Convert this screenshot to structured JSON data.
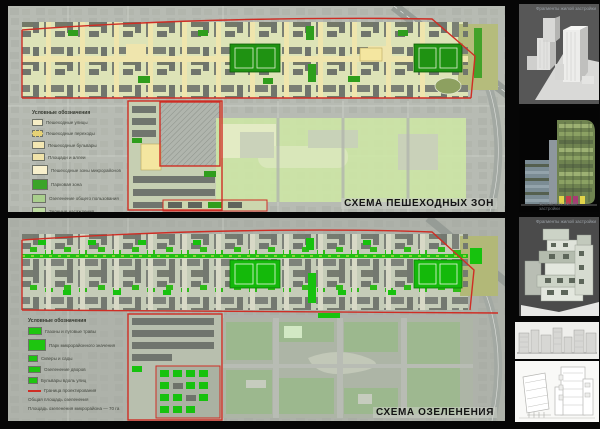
{
  "board": {
    "title": "Градостроительная концепция — схемы микрорайона"
  },
  "maps": [
    {
      "caption": "СХЕМА ПЕШЕХОДНЫХ ЗОН",
      "legend": {
        "title": "Условные обозначения",
        "items": [
          {
            "swatch": "#f6eec6",
            "label": "Пешеходные улицы"
          },
          {
            "swatch": "#e6d275",
            "label": "Пешеходные переходы"
          },
          {
            "swatch": "#f3e7b2",
            "label": "Пешеходные бульвары"
          },
          {
            "swatch": "#f0e3a9",
            "label": "Площади и аллеи"
          },
          {
            "swatch": "#f8f0cc",
            "label": "Пешеходные зоны микрорайонов"
          },
          {
            "swatch": "#3aa428",
            "label": "Парковая зона"
          },
          {
            "swatch": "#a9cf8c",
            "label": "Озеленение общего пользования"
          },
          {
            "swatch": "#bedca2",
            "label": "Зеленые насаждения"
          }
        ]
      }
    },
    {
      "caption": "СХЕМА ОЗЕЛЕНЕНИЯ",
      "legend": {
        "title": "Условные обозначения",
        "items": [
          {
            "swatch": "#1ec510",
            "label": "Газоны и луговые травы"
          },
          {
            "swatch": "#1ec510",
            "label": "Парк микрорайонного значения"
          },
          {
            "swatch": "#1ec510",
            "label": "Скверы и сады"
          },
          {
            "swatch": "#1ec510",
            "label": "Озеленение дворов"
          },
          {
            "swatch": "#1ec510",
            "label": "Бульвары вдоль улиц"
          },
          {
            "swatch": "#cf2d24",
            "label": "Граница проектирования"
          }
        ],
        "notes": [
          "Общая площадь озеленения",
          "Площадь озеленения микрорайона — 70 га"
        ]
      }
    }
  ],
  "renders": [
    {
      "caption": "Фрагменты жилой застройки"
    },
    {
      "caption": "Фрагменты жилой застройки"
    },
    {
      "caption": "Фрагменты жилой застройки"
    },
    {
      "caption": ""
    },
    {
      "caption": ""
    }
  ],
  "colors": {
    "boundary_red": "#cf2d24",
    "pedestrian_cream": "#efe5ad",
    "court_green": "#1f9212",
    "greening_green": "#17c20e",
    "park_tint": "#cfe9a4",
    "map_base": "#b7bbb3"
  }
}
